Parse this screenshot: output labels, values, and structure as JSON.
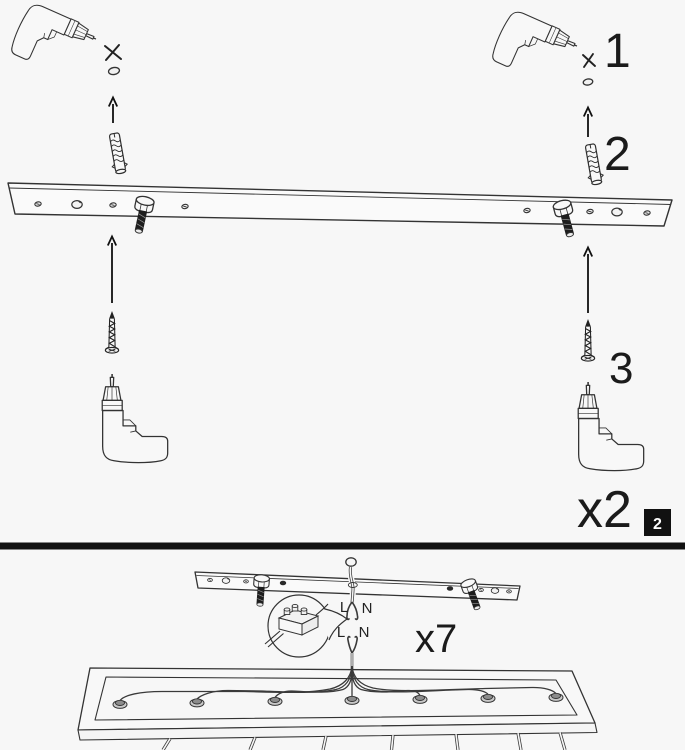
{
  "sheet": {
    "background": "#f7f7f7",
    "ink": "#333333",
    "black": "#111111"
  },
  "step_panel": {
    "badge": "2",
    "multiplier": "x2",
    "callout_drill": "1",
    "callout_anchor": "2",
    "callout_screw": "3"
  },
  "wiring_panel": {
    "multiplier": "x7",
    "supply_l": "L",
    "supply_n": "N",
    "fixture_l": "L",
    "fixture_n": "N"
  },
  "icon_names": [
    "drill-icon",
    "x-mark-icon",
    "pilot-hole-icon",
    "arrow-up-icon",
    "wall-anchor-icon",
    "bolt-icon",
    "screw-icon",
    "mounting-bar",
    "ceiling-bar",
    "suspension-wire",
    "terminal-block-icon",
    "magnifier-callout",
    "fixture-frame",
    "cable-gland-icon",
    "pendant-cord"
  ]
}
